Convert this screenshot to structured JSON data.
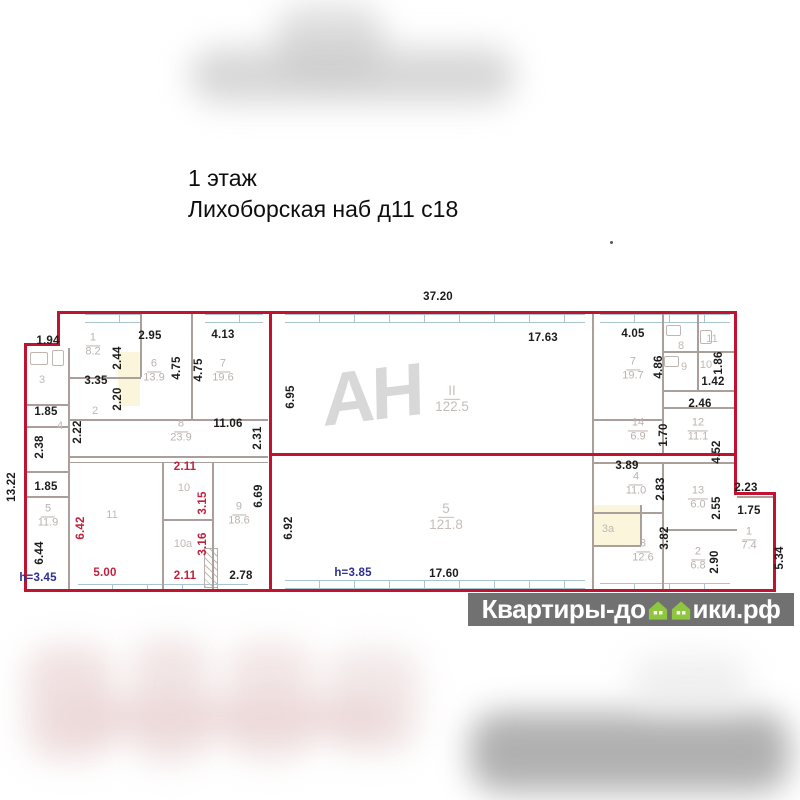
{
  "title": {
    "line1": "1 этаж",
    "line2": "Лихоборская наб д11 с18"
  },
  "watermark_center": "АН",
  "watermark_bottom": {
    "prefix": "Квартиры-до",
    "suffix": "ики.рф"
  },
  "colors": {
    "outline_red": "#c1132f",
    "wall_gray": "#ab9f9c",
    "dim_black": "#1c1c1c",
    "dim_red": "#c2203c",
    "height_navy": "#2c2f8f",
    "room_label_gray": "#bcb1ad",
    "house_green": "#8ec63f",
    "band_gray": "#5c5c5c"
  },
  "plan": {
    "overall_width_m": "37.20",
    "overall_height_m": "13.22",
    "rooms": [
      {
        "num": "1",
        "area": "8.2",
        "x": 93,
        "y": 345
      },
      {
        "num": "6",
        "area": "13.9",
        "x": 154,
        "y": 371
      },
      {
        "num": "7",
        "area": "19.6",
        "x": 223,
        "y": 371
      },
      {
        "num": "8",
        "area": "23.9",
        "x": 181,
        "y": 431
      },
      {
        "num": "5",
        "area": "11.9",
        "x": 48,
        "y": 516
      },
      {
        "num": "9",
        "area": "18.6",
        "x": 239,
        "y": 514
      },
      {
        "num": "II",
        "area": "122.5",
        "x": 452,
        "y": 399,
        "big": 1
      },
      {
        "num": "5",
        "area": "121.8",
        "x": 446,
        "y": 517,
        "big": 1
      },
      {
        "num": "7",
        "area": "19.7",
        "x": 633,
        "y": 369
      },
      {
        "num": "14",
        "area": "6.9",
        "x": 638,
        "y": 430
      },
      {
        "num": "12",
        "area": "11.1",
        "x": 698,
        "y": 430
      },
      {
        "num": "4",
        "area": "11.0",
        "x": 636,
        "y": 484
      },
      {
        "num": "13",
        "area": "6.0",
        "x": 698,
        "y": 498
      },
      {
        "num": "3",
        "area": "12.6",
        "x": 643,
        "y": 551
      },
      {
        "num": "2",
        "area": "6.8",
        "x": 698,
        "y": 559
      },
      {
        "num": "1",
        "area": "7.4",
        "x": 749,
        "y": 539
      }
    ],
    "room_numbers": [
      {
        "text": "2",
        "x": 95,
        "y": 411
      },
      {
        "text": "3",
        "x": 42,
        "y": 380
      },
      {
        "text": "4",
        "x": 60,
        "y": 426
      },
      {
        "text": "11",
        "x": 112,
        "y": 515
      },
      {
        "text": "10",
        "x": 184,
        "y": 488
      },
      {
        "text": "10а",
        "x": 183,
        "y": 544
      },
      {
        "text": "8",
        "x": 681,
        "y": 346
      },
      {
        "text": "11",
        "x": 712,
        "y": 339
      },
      {
        "text": "9",
        "x": 684,
        "y": 367
      },
      {
        "text": "10",
        "x": 706,
        "y": 365
      },
      {
        "text": "3а",
        "x": 608,
        "y": 529
      }
    ],
    "dims": [
      {
        "text": "37.20",
        "x": 438,
        "y": 297
      },
      {
        "text": "17.63",
        "x": 543,
        "y": 338
      },
      {
        "text": "1.94",
        "x": 48,
        "y": 341
      },
      {
        "text": "13.22",
        "x": 12,
        "y": 487,
        "rot": 1
      },
      {
        "text": "2.95",
        "x": 150,
        "y": 336
      },
      {
        "text": "4.13",
        "x": 223,
        "y": 335
      },
      {
        "text": "2.44",
        "x": 118,
        "y": 358,
        "rot": 1
      },
      {
        "text": "3.35",
        "x": 96,
        "y": 381
      },
      {
        "text": "2.20",
        "x": 118,
        "y": 399,
        "rot": 1
      },
      {
        "text": "4.75",
        "x": 177,
        "y": 368,
        "rot": 1
      },
      {
        "text": "4.75",
        "x": 199,
        "y": 370,
        "rot": 1
      },
      {
        "text": "1.85",
        "x": 46,
        "y": 412
      },
      {
        "text": "2.38",
        "x": 40,
        "y": 447,
        "rot": 1
      },
      {
        "text": "2.22",
        "x": 78,
        "y": 432,
        "rot": 1
      },
      {
        "text": "11.06",
        "x": 228,
        "y": 424
      },
      {
        "text": "2.31",
        "x": 258,
        "y": 438,
        "rot": 1
      },
      {
        "text": "1.85",
        "x": 46,
        "y": 487
      },
      {
        "text": "6.44",
        "x": 40,
        "y": 553,
        "rot": 1
      },
      {
        "text": "h=3.45",
        "x": 38,
        "y": 578,
        "cls": "navy"
      },
      {
        "text": "6.42",
        "x": 81,
        "y": 528,
        "rot": 1,
        "cls": "red-t"
      },
      {
        "text": "5.00",
        "x": 105,
        "y": 573,
        "cls": "red-t"
      },
      {
        "text": "2.11",
        "x": 185,
        "y": 467,
        "cls": "red-t"
      },
      {
        "text": "3.15",
        "x": 203,
        "y": 503,
        "rot": 1,
        "cls": "red-t"
      },
      {
        "text": "3.16",
        "x": 203,
        "y": 544,
        "rot": 1,
        "cls": "red-t"
      },
      {
        "text": "2.11",
        "x": 185,
        "y": 576,
        "cls": "red-t"
      },
      {
        "text": "6.69",
        "x": 259,
        "y": 496,
        "rot": 1
      },
      {
        "text": "2.78",
        "x": 241,
        "y": 576
      },
      {
        "text": "6.95",
        "x": 291,
        "y": 397,
        "rot": 1
      },
      {
        "text": "6.92",
        "x": 289,
        "y": 528,
        "rot": 1
      },
      {
        "text": "h=3.85",
        "x": 353,
        "y": 573,
        "cls": "navy"
      },
      {
        "text": "17.60",
        "x": 444,
        "y": 574
      },
      {
        "text": "4.05",
        "x": 633,
        "y": 334
      },
      {
        "text": "4.86",
        "x": 659,
        "y": 367,
        "rot": 1
      },
      {
        "text": "1.86",
        "x": 719,
        "y": 363,
        "rot": 1
      },
      {
        "text": "1.42",
        "x": 713,
        "y": 382
      },
      {
        "text": "2.46",
        "x": 700,
        "y": 404
      },
      {
        "text": "1.70",
        "x": 664,
        "y": 435,
        "rot": 1
      },
      {
        "text": "4.52",
        "x": 717,
        "y": 452,
        "rot": 1
      },
      {
        "text": "3.89",
        "x": 627,
        "y": 466
      },
      {
        "text": "2.83",
        "x": 661,
        "y": 489,
        "rot": 1
      },
      {
        "text": "2.55",
        "x": 717,
        "y": 508,
        "rot": 1
      },
      {
        "text": "2.23",
        "x": 746,
        "y": 488
      },
      {
        "text": "1.75",
        "x": 749,
        "y": 511
      },
      {
        "text": "5.34",
        "x": 780,
        "y": 558,
        "rot": 1
      },
      {
        "text": "3.82",
        "x": 665,
        "y": 538,
        "rot": 1
      },
      {
        "text": "2.90",
        "x": 715,
        "y": 562,
        "rot": 1
      }
    ]
  }
}
